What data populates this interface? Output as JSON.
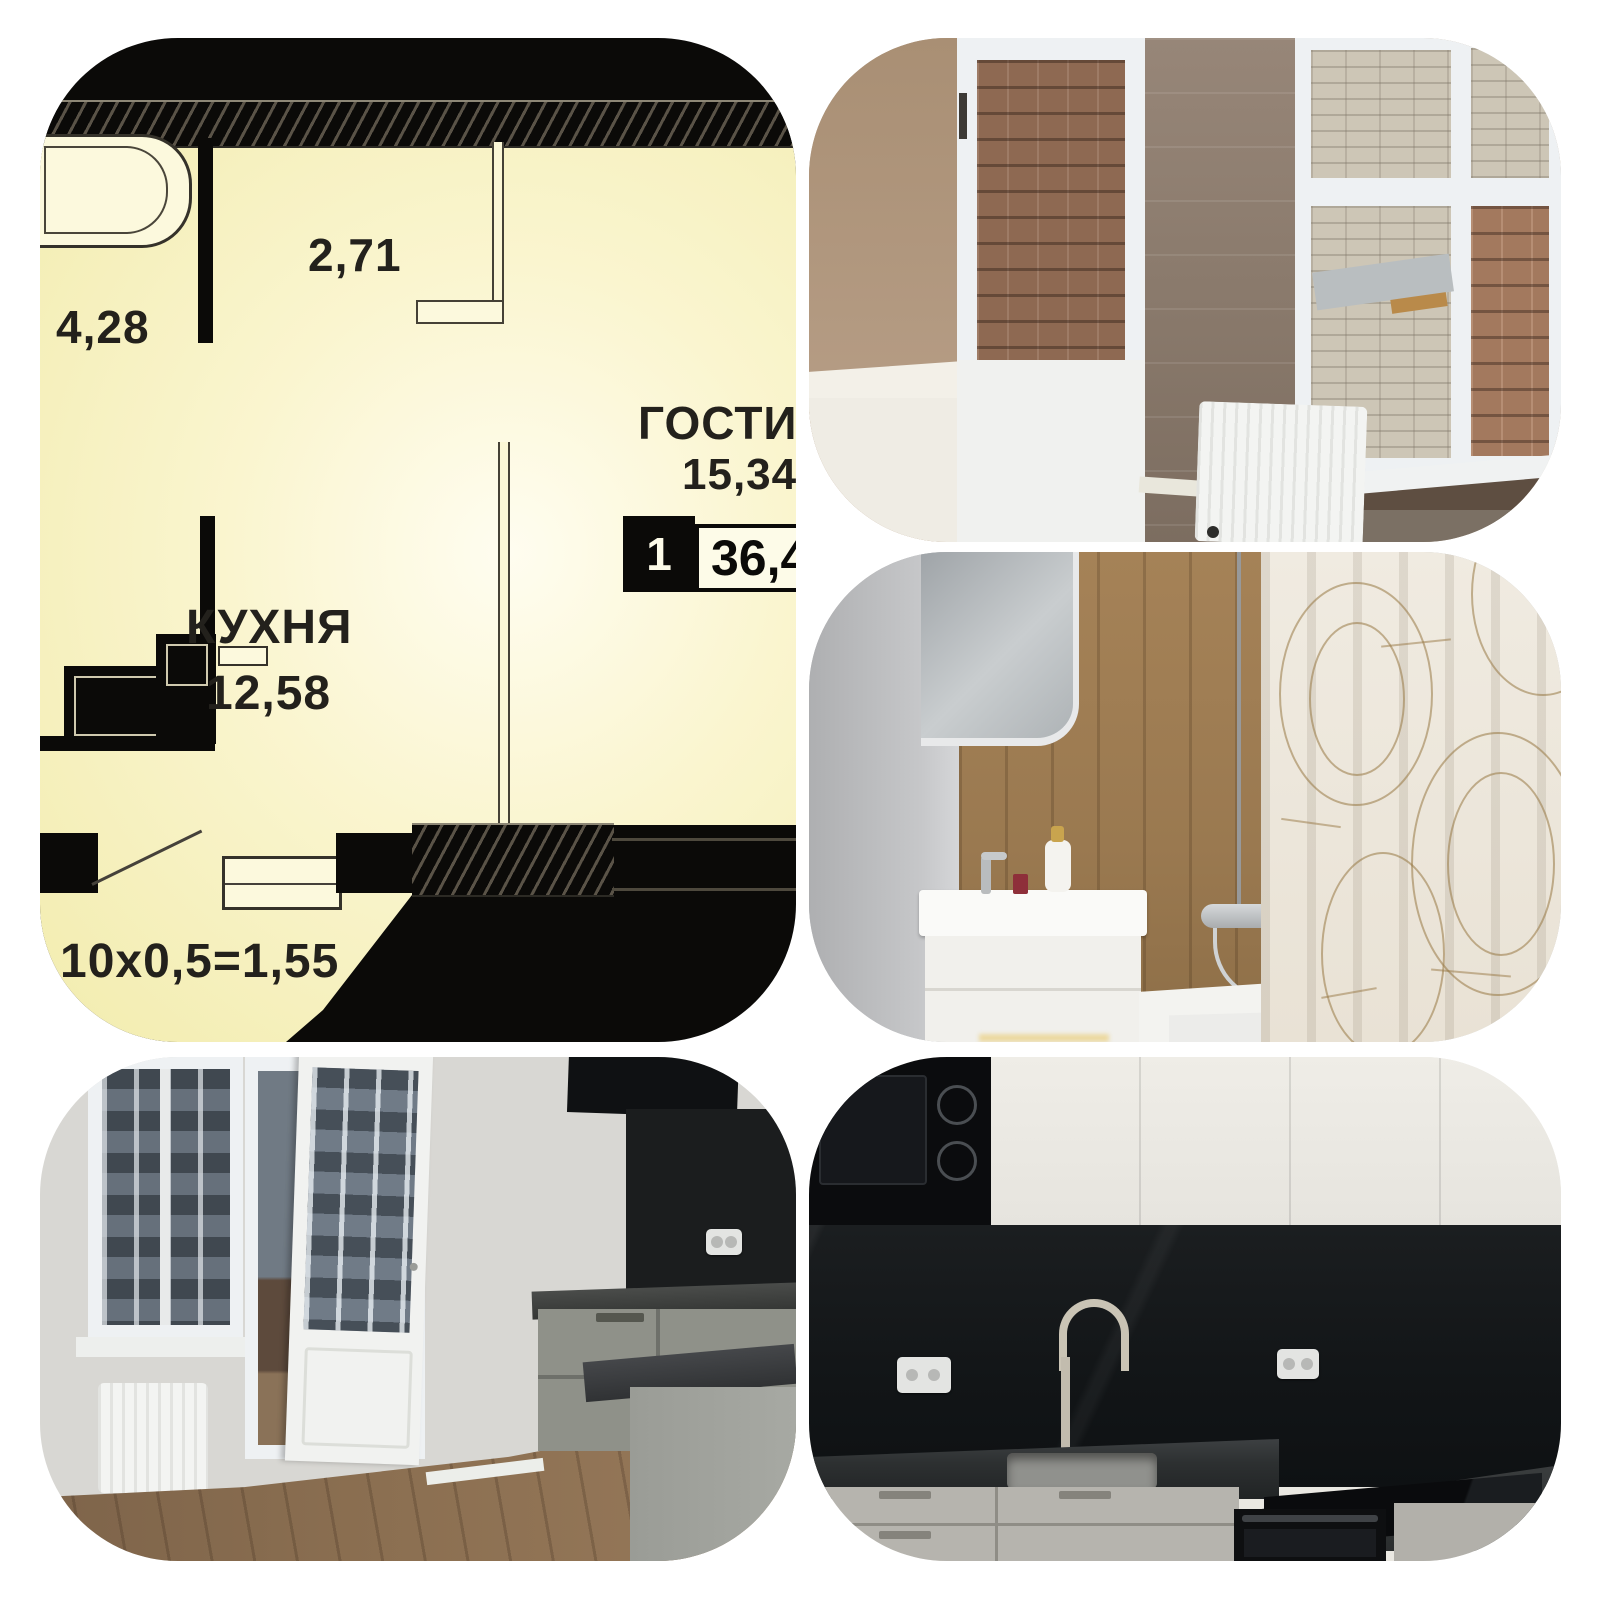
{
  "page": {
    "type": "apartment-listing-photo-collage",
    "background": "#ffffff"
  },
  "floorplan": {
    "dim_top": "2,71",
    "dim_left": "4,28",
    "living_name": "ГОСТИНАЯ",
    "living_area": "15,34",
    "kitchen_name": "КУХНЯ",
    "kitchen_area": "12,58",
    "badge_rooms": "1",
    "badge_area": "36,4",
    "note": "3,10x0,5=1,55",
    "colors": {
      "plan_black": "#0b0a08",
      "plan_yellow_edge": "#f2ecae",
      "plan_yellow_center": "#fffdf0",
      "plan_text": "#23211c"
    }
  },
  "photos": {
    "balcony": {
      "scene": "glazed balcony with brick view, wood panel wall and radiator",
      "wall_beige": "#ab937a",
      "wood_wall": "#8f7e70",
      "window_frame": "#eef1f3",
      "brick_red": "#8e6952",
      "brick_white": "#cdc6b6",
      "radiator": "#f3f4f2",
      "parapet": "#5e4e41"
    },
    "bathroom": {
      "scene": "bathroom with white vanity, wood-look tiles, tub and patterned curtain",
      "wall_gray": "#b9babc",
      "tile_wood": "#a07e56",
      "vanity": "#f1f0ec",
      "curtain": "#ece6da",
      "pattern_line": "#a98a5c",
      "tub": "#f3f3f0"
    },
    "kitchen_balcony_door": {
      "scene": "kitchen corner with open white balcony door and grey cabinets",
      "wall": "#d8d7d3",
      "floor_wood": "#8b6f51",
      "cabinet_grey": "#8f9189",
      "counter_dark": "#3b3d3b",
      "backsplash_black": "#1b1d1e",
      "facade_view": "#66707b"
    },
    "kitchen_dark_stone": {
      "scene": "kitchen with white uppers, black marble backsplash, sink, cooktop and oven",
      "upper_cabinets": "#eae8e2",
      "backsplash_marble": "#15181a",
      "counter_marble": "#2d3031",
      "lower_cabinets": "#b6b4ae",
      "appliance_black": "#0b0c0e",
      "faucet": "#cac4b5"
    }
  }
}
